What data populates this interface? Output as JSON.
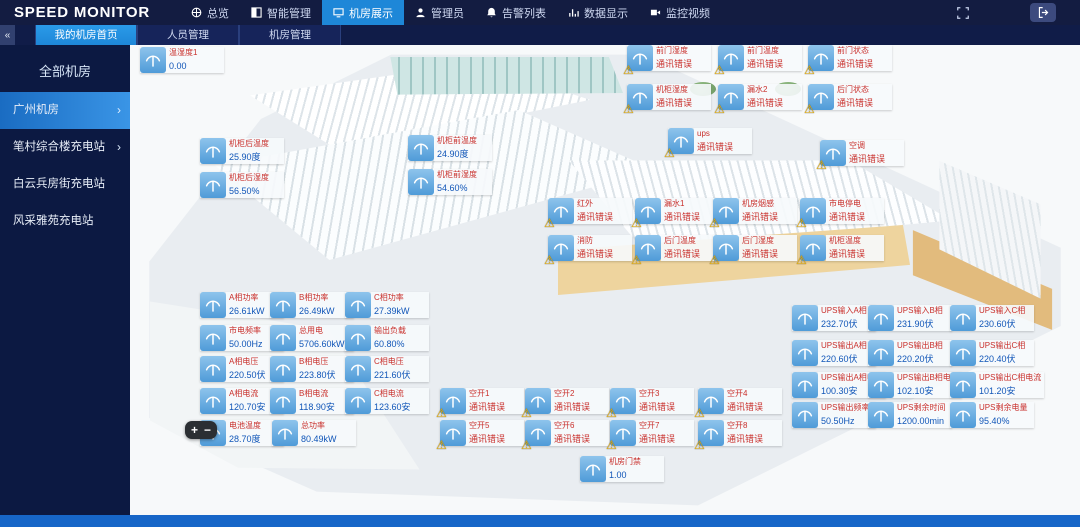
{
  "header": {
    "logo": "SPEED MONITOR",
    "nav": [
      {
        "label": "总览",
        "icon": "overview",
        "active": false
      },
      {
        "label": "智能管理",
        "icon": "smart",
        "active": false
      },
      {
        "label": "机房展示",
        "icon": "rooms",
        "active": true
      },
      {
        "label": "管理员",
        "icon": "admin",
        "active": false
      },
      {
        "label": "告警列表",
        "icon": "alarms",
        "active": false
      },
      {
        "label": "数据显示",
        "icon": "data",
        "active": false
      },
      {
        "label": "监控视频",
        "icon": "video",
        "active": false
      }
    ]
  },
  "tabbar": {
    "collapse_label": "«",
    "tabs": [
      {
        "label": "我的机房首页",
        "active": true
      },
      {
        "label": "人员管理",
        "active": false
      },
      {
        "label": "机房管理",
        "active": false
      }
    ]
  },
  "sidebar": {
    "title": "全部机房",
    "items": [
      {
        "label": "广州机房",
        "active": true,
        "arrow": true
      },
      {
        "label": "笔村综合楼充电站",
        "active": false,
        "arrow": true
      },
      {
        "label": "白云兵房街充电站",
        "active": false,
        "arrow": false
      },
      {
        "label": "风采雅苑充电站",
        "active": false,
        "arrow": false
      }
    ]
  },
  "map": {
    "zoom_controls": {
      "plus": "+",
      "minus": "−"
    },
    "sensors": [
      {
        "x": 140,
        "y": 47,
        "title": "温湿度1",
        "value": "0.00",
        "alarm": false
      },
      {
        "x": 200,
        "y": 138,
        "title": "机柜后温度",
        "value": "25.90度",
        "alarm": false
      },
      {
        "x": 200,
        "y": 172,
        "title": "机柜后湿度",
        "value": "56.50%",
        "alarm": false
      },
      {
        "x": 408,
        "y": 135,
        "title": "机柜前温度",
        "value": "24.90度",
        "alarm": false
      },
      {
        "x": 408,
        "y": 169,
        "title": "机柜前湿度",
        "value": "54.60%",
        "alarm": false
      },
      {
        "x": 627,
        "y": 45,
        "title": "前门湿度",
        "value": "通讯错误",
        "alarm": true
      },
      {
        "x": 718,
        "y": 45,
        "title": "前门温度",
        "value": "通讯错误",
        "alarm": true
      },
      {
        "x": 808,
        "y": 45,
        "title": "前门状态",
        "value": "通讯错误",
        "alarm": true
      },
      {
        "x": 627,
        "y": 84,
        "title": "机柜湿度",
        "value": "通讯错误",
        "alarm": true
      },
      {
        "x": 718,
        "y": 84,
        "title": "漏水2",
        "value": "通讯错误",
        "alarm": true
      },
      {
        "x": 808,
        "y": 84,
        "title": "后门状态",
        "value": "通讯错误",
        "alarm": true
      },
      {
        "x": 668,
        "y": 128,
        "title": "ups",
        "value": "通讯错误",
        "alarm": true
      },
      {
        "x": 820,
        "y": 140,
        "title": "空调",
        "value": "通讯错误",
        "alarm": true
      },
      {
        "x": 548,
        "y": 198,
        "title": "红外",
        "value": "通讯错误",
        "alarm": true
      },
      {
        "x": 635,
        "y": 198,
        "title": "漏水1",
        "value": "通讯错误",
        "alarm": true
      },
      {
        "x": 713,
        "y": 198,
        "title": "机房烟感",
        "value": "通讯错误",
        "alarm": true
      },
      {
        "x": 800,
        "y": 198,
        "title": "市电停电",
        "value": "通讯错误",
        "alarm": true
      },
      {
        "x": 548,
        "y": 235,
        "title": "消防",
        "value": "通讯错误",
        "alarm": true
      },
      {
        "x": 635,
        "y": 235,
        "title": "后门温度",
        "value": "通讯错误",
        "alarm": true
      },
      {
        "x": 713,
        "y": 235,
        "title": "后门湿度",
        "value": "通讯错误",
        "alarm": true
      },
      {
        "x": 800,
        "y": 235,
        "title": "机柜温度",
        "value": "通讯错误",
        "alarm": true
      },
      {
        "x": 200,
        "y": 292,
        "title": "A相功率",
        "value": "26.61kW",
        "alarm": false
      },
      {
        "x": 270,
        "y": 292,
        "title": "B相功率",
        "value": "26.49kW",
        "alarm": false
      },
      {
        "x": 345,
        "y": 292,
        "title": "C相功率",
        "value": "27.39kW",
        "alarm": false
      },
      {
        "x": 200,
        "y": 325,
        "title": "市电频率",
        "value": "50.00Hz",
        "alarm": false
      },
      {
        "x": 270,
        "y": 325,
        "title": "总用电",
        "value": "5706.60kWh",
        "alarm": false
      },
      {
        "x": 345,
        "y": 325,
        "title": "输出负载",
        "value": "60.80%",
        "alarm": false
      },
      {
        "x": 200,
        "y": 356,
        "title": "A相电压",
        "value": "220.50伏",
        "alarm": false
      },
      {
        "x": 270,
        "y": 356,
        "title": "B相电压",
        "value": "223.80伏",
        "alarm": false
      },
      {
        "x": 345,
        "y": 356,
        "title": "C相电压",
        "value": "221.60伏",
        "alarm": false
      },
      {
        "x": 200,
        "y": 388,
        "title": "A相电流",
        "value": "120.70安",
        "alarm": false
      },
      {
        "x": 270,
        "y": 388,
        "title": "B相电流",
        "value": "118.90安",
        "alarm": false
      },
      {
        "x": 345,
        "y": 388,
        "title": "C相电流",
        "value": "123.60安",
        "alarm": false
      },
      {
        "x": 200,
        "y": 420,
        "title": "电池温度",
        "value": "28.70度",
        "alarm": false
      },
      {
        "x": 272,
        "y": 420,
        "title": "总功率",
        "value": "80.49kW",
        "alarm": false
      },
      {
        "x": 440,
        "y": 388,
        "title": "空开1",
        "value": "通讯错误",
        "alarm": true
      },
      {
        "x": 525,
        "y": 388,
        "title": "空开2",
        "value": "通讯错误",
        "alarm": true
      },
      {
        "x": 610,
        "y": 388,
        "title": "空开3",
        "value": "通讯错误",
        "alarm": true
      },
      {
        "x": 698,
        "y": 388,
        "title": "空开4",
        "value": "通讯错误",
        "alarm": true
      },
      {
        "x": 440,
        "y": 420,
        "title": "空开5",
        "value": "通讯错误",
        "alarm": true
      },
      {
        "x": 525,
        "y": 420,
        "title": "空开6",
        "value": "通讯错误",
        "alarm": true
      },
      {
        "x": 610,
        "y": 420,
        "title": "空开7",
        "value": "通讯错误",
        "alarm": true
      },
      {
        "x": 698,
        "y": 420,
        "title": "空开8",
        "value": "通讯错误",
        "alarm": true
      },
      {
        "x": 792,
        "y": 305,
        "title": "UPS输入A相",
        "value": "232.70伏",
        "alarm": false
      },
      {
        "x": 868,
        "y": 305,
        "title": "UPS输入B相",
        "value": "231.90伏",
        "alarm": false
      },
      {
        "x": 950,
        "y": 305,
        "title": "UPS输入C相",
        "value": "230.60伏",
        "alarm": false
      },
      {
        "x": 792,
        "y": 340,
        "title": "UPS输出A相",
        "value": "220.60伏",
        "alarm": false
      },
      {
        "x": 868,
        "y": 340,
        "title": "UPS输出B相",
        "value": "220.20伏",
        "alarm": false
      },
      {
        "x": 950,
        "y": 340,
        "title": "UPS输出C相",
        "value": "220.40伏",
        "alarm": false
      },
      {
        "x": 792,
        "y": 372,
        "title": "UPS输出A相电流",
        "value": "100.30安",
        "alarm": false
      },
      {
        "x": 868,
        "y": 372,
        "title": "UPS输出B相电流",
        "value": "102.10安",
        "alarm": false
      },
      {
        "x": 950,
        "y": 372,
        "title": "UPS输出C相电流",
        "value": "101.20安",
        "alarm": false
      },
      {
        "x": 792,
        "y": 402,
        "title": "UPS输出频率",
        "value": "50.50Hz",
        "alarm": false
      },
      {
        "x": 868,
        "y": 402,
        "title": "UPS剩余时间",
        "value": "1200.00min",
        "alarm": false
      },
      {
        "x": 950,
        "y": 402,
        "title": "UPS剩余电量",
        "value": "95.40%",
        "alarm": false
      },
      {
        "x": 580,
        "y": 456,
        "title": "机房门禁",
        "value": "1.00",
        "alarm": false
      }
    ]
  },
  "colors": {
    "accent": "#1e87d8",
    "alarm_red": "#c9302c",
    "value_blue": "#1156b8",
    "icon_blue": "#5aa7e0",
    "topbar_bg": "#131c41",
    "sidebar_bg": "#0c1942",
    "footer_blue": "#1766c8"
  }
}
